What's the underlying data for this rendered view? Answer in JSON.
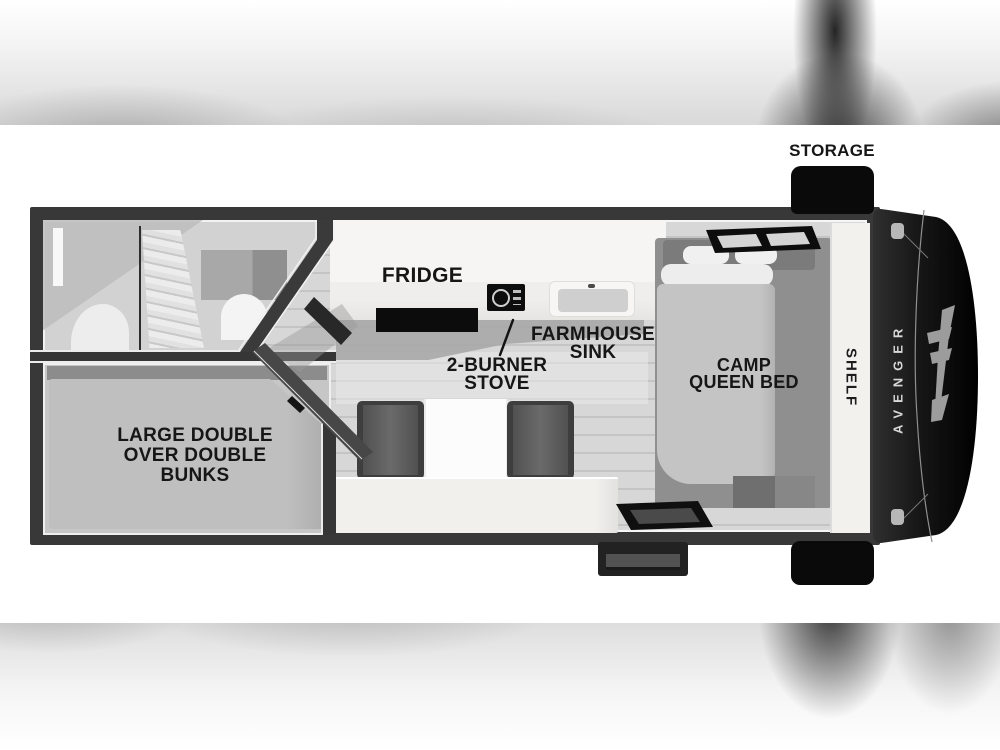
{
  "scene": "rv-travel-trailer-floorplan-top-view",
  "brand": "AVENGER",
  "labels": {
    "storage": "STORAGE",
    "fridge": "FRIDGE",
    "farmhouse_sink": [
      "FARMHOUSE",
      "SINK"
    ],
    "two_burner_stove": [
      "2-BURNER",
      "STOVE"
    ],
    "camp_queen_bed": [
      "CAMP",
      "QUEEN BED"
    ],
    "bunks": [
      "LARGE DOUBLE",
      "OVER DOUBLE",
      "BUNKS"
    ],
    "shelf": "SHELF"
  },
  "colors": {
    "wall": "#383838",
    "black_fixture": "#0a0a0a",
    "floor": "#d6d6d6",
    "counter": "#f4f2f0",
    "label_text": "#161616",
    "cap_text": "#d8d8d8"
  }
}
